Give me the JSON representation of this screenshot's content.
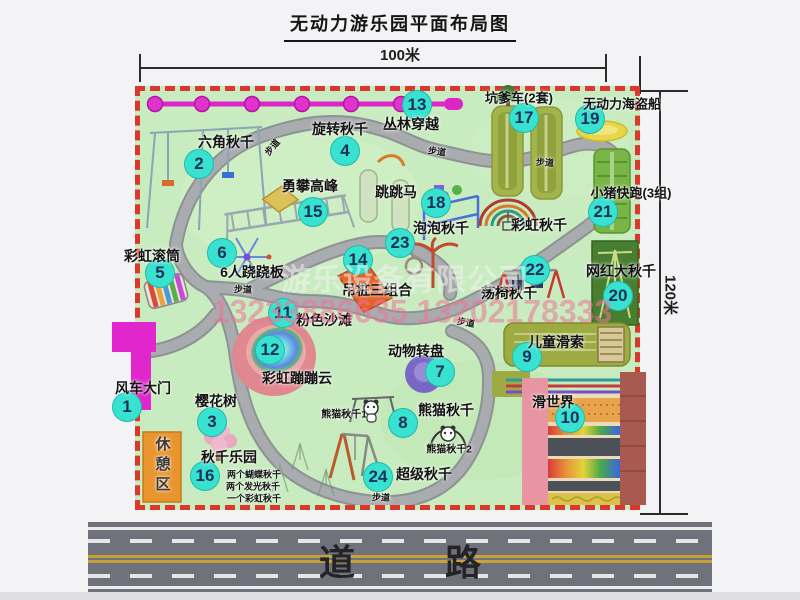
{
  "title": "无动力游乐园平面布局图",
  "dimensions": {
    "top": "100米",
    "right": "120米"
  },
  "road": {
    "label": "道路"
  },
  "watermark": {
    "company": "游乐设备有限公司",
    "phone": "13233886635 13202178333"
  },
  "colors": {
    "badge": "#38e2d1",
    "border_dash": "#d9382b",
    "park_green": "#c8ebbf",
    "gate_magenta": "#e026cc",
    "road_gray": "#6f727a"
  },
  "attractions": [
    {
      "num": "1",
      "label": "风车大门",
      "bx": 127,
      "by": 407,
      "lx": 143,
      "ly": 388
    },
    {
      "num": "2",
      "label": "六角秋千",
      "bx": 199,
      "by": 164,
      "lx": 226,
      "ly": 142
    },
    {
      "num": "3",
      "label": "樱花树",
      "bx": 212,
      "by": 422,
      "lx": 216,
      "ly": 401
    },
    {
      "num": "4",
      "label": "旋转秋千",
      "bx": 345,
      "by": 151,
      "lx": 340,
      "ly": 129
    },
    {
      "num": "5",
      "label": "彩虹滚筒",
      "bx": 160,
      "by": 273,
      "lx": 152,
      "ly": 256
    },
    {
      "num": "6",
      "label": "6人跷跷板",
      "bx": 222,
      "by": 253,
      "lx": 252,
      "ly": 272
    },
    {
      "num": "7",
      "label": "动物转盘",
      "bx": 440,
      "by": 372,
      "lx": 416,
      "ly": 351
    },
    {
      "num": "8",
      "label": "熊猫秋千",
      "bx": 403,
      "by": 423,
      "lx": 446,
      "ly": 410
    },
    {
      "num": "9",
      "label": "儿童滑索",
      "bx": 527,
      "by": 357,
      "lx": 556,
      "ly": 342
    },
    {
      "num": "10",
      "label": "滑世界",
      "bx": 570,
      "by": 418,
      "lx": 553,
      "ly": 402
    },
    {
      "num": "11",
      "label": "粉色沙滩",
      "bx": 283,
      "by": 313,
      "lx": 324,
      "ly": 320
    },
    {
      "num": "12",
      "label": "彩虹蹦蹦云",
      "bx": 270,
      "by": 350,
      "lx": 297,
      "ly": 378
    },
    {
      "num": "13",
      "label": "丛林穿越",
      "bx": 417,
      "by": 105,
      "lx": 411,
      "ly": 124
    },
    {
      "num": "14",
      "label": "吊桩三组合",
      "bx": 358,
      "by": 260,
      "lx": 377,
      "ly": 290
    },
    {
      "num": "15",
      "label": "勇攀高峰",
      "bx": 313,
      "by": 212,
      "lx": 310,
      "ly": 186
    },
    {
      "num": "16",
      "label": "秋千乐园",
      "bx": 205,
      "by": 476,
      "lx": 229,
      "ly": 457
    },
    {
      "num": "17",
      "label": "坑爹车(2套)",
      "bx": 524,
      "by": 118,
      "lx": 519,
      "ly": 97,
      "size": 13
    },
    {
      "num": "18",
      "label": "跳跳马",
      "bx": 436,
      "by": 203,
      "lx": 396,
      "ly": 192
    },
    {
      "num": "19",
      "label": "无动力海盗船",
      "bx": 590,
      "by": 119,
      "lx": 622,
      "ly": 103,
      "size": 13
    },
    {
      "num": "20",
      "label": "网红大秋千",
      "bx": 618,
      "by": 296,
      "lx": 621,
      "ly": 271
    },
    {
      "num": "21",
      "label": "小猪快跑(3组)",
      "bx": 603,
      "by": 212,
      "lx": 631,
      "ly": 192,
      "size": 13
    },
    {
      "num": "22",
      "label": "荡椅秋千",
      "bx": 535,
      "by": 270,
      "lx": 509,
      "ly": 293
    },
    {
      "num": "23",
      "label": "泡泡秋千",
      "bx": 400,
      "by": 243,
      "lx": 441,
      "ly": 228
    },
    {
      "num": "24",
      "label": "超级秋千",
      "bx": 378,
      "by": 477,
      "lx": 424,
      "ly": 474
    }
  ],
  "extra_labels": [
    {
      "text": "彩虹秋千",
      "x": 539,
      "y": 225,
      "size": 14
    },
    {
      "text": "休憩区",
      "x": 162,
      "y": 466,
      "size": 15,
      "vertical": true
    },
    {
      "text": "熊猫秋千1",
      "x": 344,
      "y": 413,
      "size": 10
    },
    {
      "text": "熊猫秋千2",
      "x": 449,
      "y": 448,
      "size": 10
    },
    {
      "text": "两个蝴蝶秋千",
      "x": 254,
      "y": 474,
      "size": 9
    },
    {
      "text": "两个发光秋千",
      "x": 253,
      "y": 486,
      "size": 9
    },
    {
      "text": "一个彩虹秋千",
      "x": 254,
      "y": 498,
      "size": 9
    },
    {
      "text": "步道",
      "x": 272,
      "y": 147,
      "size": 9,
      "rot": -50
    },
    {
      "text": "步道",
      "x": 437,
      "y": 151,
      "size": 9,
      "rot": 8
    },
    {
      "text": "步道",
      "x": 545,
      "y": 162,
      "size": 9,
      "rot": 4
    },
    {
      "text": "步道",
      "x": 243,
      "y": 289,
      "size": 9,
      "rot": 2
    },
    {
      "text": "步道",
      "x": 466,
      "y": 322,
      "size": 9,
      "rot": 10
    },
    {
      "text": "步道",
      "x": 381,
      "y": 497,
      "size": 9,
      "rot": 2
    }
  ]
}
